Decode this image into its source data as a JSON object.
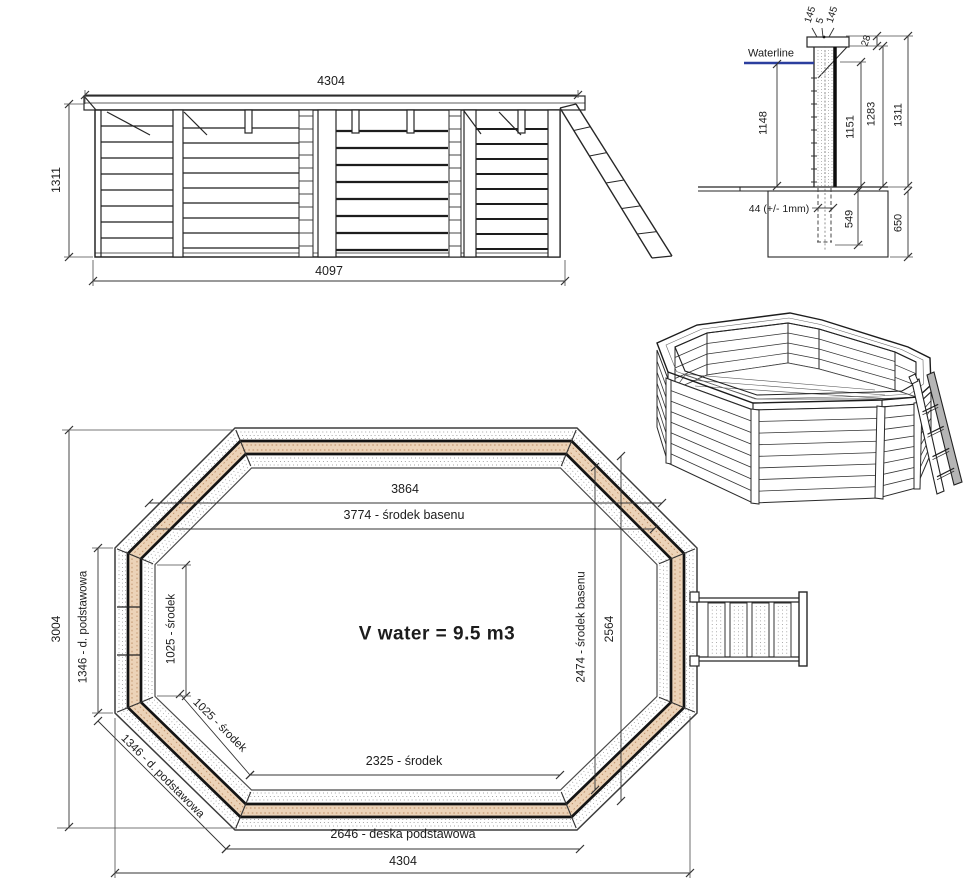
{
  "side_view": {
    "dim_top_width": "4304",
    "dim_height": "1311",
    "dim_bottom_width": "4097"
  },
  "detail_view": {
    "waterline_label": "Waterline",
    "dim_cap_board_a": "145",
    "dim_cap_gap": "5",
    "dim_cap_board_b": "145",
    "dim_cap_rise": "28",
    "dim_water_height": "1148",
    "dim_wall_inner_height": "1151",
    "dim_wall_height": "1283",
    "dim_total_height": "1311",
    "dim_plank_thickness": "44 (+/- 1mm)",
    "dim_post_embed": "549",
    "dim_foundation_depth": "650"
  },
  "plan_view": {
    "dim_outer_top_width": "3864",
    "dim_center_width": "3774 - środek basenu",
    "volume_label": "V water = 9.5 m3",
    "dim_outer_height": "3004",
    "dim_base_board_left": "1346 - d. podstawowa",
    "dim_center_left": "1025 - środek",
    "dim_center_diagonal": "1025 - środek",
    "dim_base_board_diagonal": "1346 - d. podstawowa",
    "dim_center_height": "2474 - środek basenu",
    "dim_inner_height": "2564",
    "dim_center_bottom": "2325 - środek",
    "dim_base_board_bottom": "2646 - deska podstawowa",
    "dim_outer_width": "4304"
  },
  "colors": {
    "line": "#222222",
    "waterline_blue": "#2b3e9e",
    "wood_band_tan": "#ecd3b8",
    "wood_hatch": "#bd8e66"
  }
}
